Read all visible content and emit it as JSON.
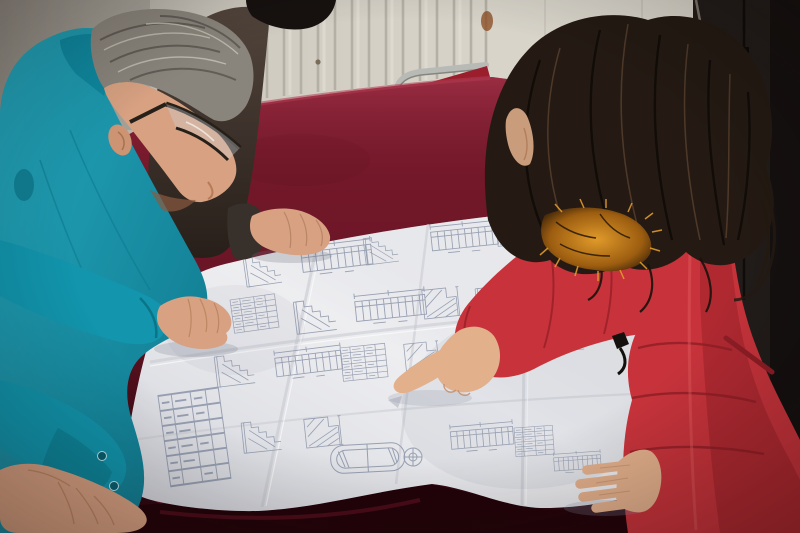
{
  "scene": {
    "kind": "photograph",
    "subject": "two-engineers-reviewing-blueprint-on-velvet-table"
  },
  "colors": {
    "wall": "#d6d2c8",
    "wall_shadow": "#a9a49b",
    "radiator_rib": "#b5b0a5",
    "door_dark": "#221d1a",
    "door_seam": "#0f0c0a",
    "stain_rust": "#8a4a1e",
    "chair_metal": "#b8bab6",
    "chair_cushion": "#9b1e2c",
    "velvet_mid": "#701728",
    "velvet_dark": "#23040a",
    "paper_light": "#f2f2f4",
    "ink_blue": "#8e97ab",
    "crease": "#c4c6cd",
    "teal_jacket": "#1295ad",
    "teal_dark": "#0a6c80",
    "teal_cuff": "#0d869b",
    "hair_gray": "#8a857c",
    "hair_black": "#171210",
    "hair_brown": "#241a13",
    "skin_man": "#d7a182",
    "skin_woman": "#e3b08c",
    "coat_red": "#c8333b",
    "coat_red_dark": "#8f1d26",
    "fur_orange": "#c67a1c",
    "glasses_frame": "#262019",
    "zipper_black": "#14100d"
  }
}
